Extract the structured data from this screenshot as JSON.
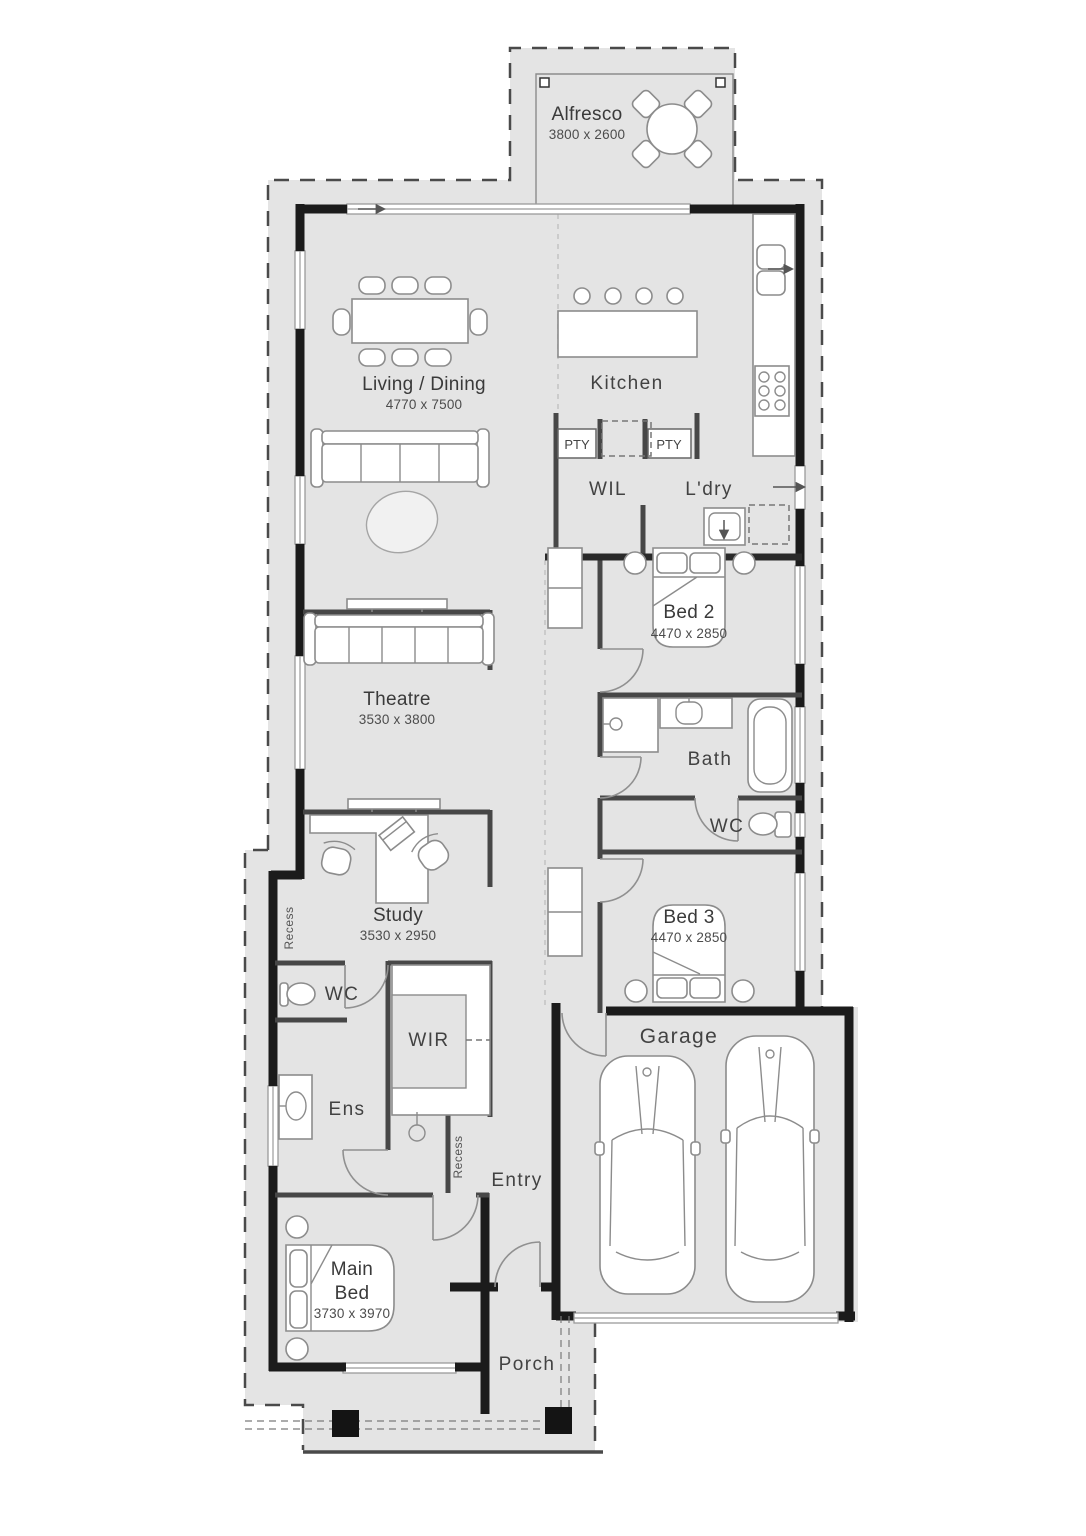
{
  "plan": {
    "alfresco": {
      "name": "Alfresco",
      "dims": "3800 x 2600"
    },
    "living_dining": {
      "name": "Living / Dining",
      "dims": "4770 x 7500"
    },
    "kitchen": {
      "name": "Kitchen"
    },
    "pty_left": "PTY",
    "pty_right": "PTY",
    "wil": "WIL",
    "ldry": "L'dry",
    "bed2": {
      "name": "Bed 2",
      "dims": "4470 x 2850"
    },
    "theatre": {
      "name": "Theatre",
      "dims": "3530 x 3800"
    },
    "bath": "Bath",
    "wc_bath": "WC",
    "study": {
      "name": "Study",
      "dims": "3530 x 2950"
    },
    "bed3": {
      "name": "Bed 3",
      "dims": "4470 x 2850"
    },
    "wc_front": "WC",
    "wir": "WIR",
    "ens": "Ens",
    "recess_side": "Recess",
    "recess_entry": "Recess",
    "entry": "Entry",
    "garage": "Garage",
    "main_bed": {
      "line1": "Main",
      "line2": "Bed",
      "dims": "3730 x 3970"
    },
    "porch": "Porch"
  },
  "colors": {
    "lot_fill": "#e4e4e4",
    "exterior_wall": "#1b1b1b",
    "interior_wall": "#474747",
    "furniture_stroke": "#8c8c8c",
    "boundary": "#4a4a4a"
  }
}
